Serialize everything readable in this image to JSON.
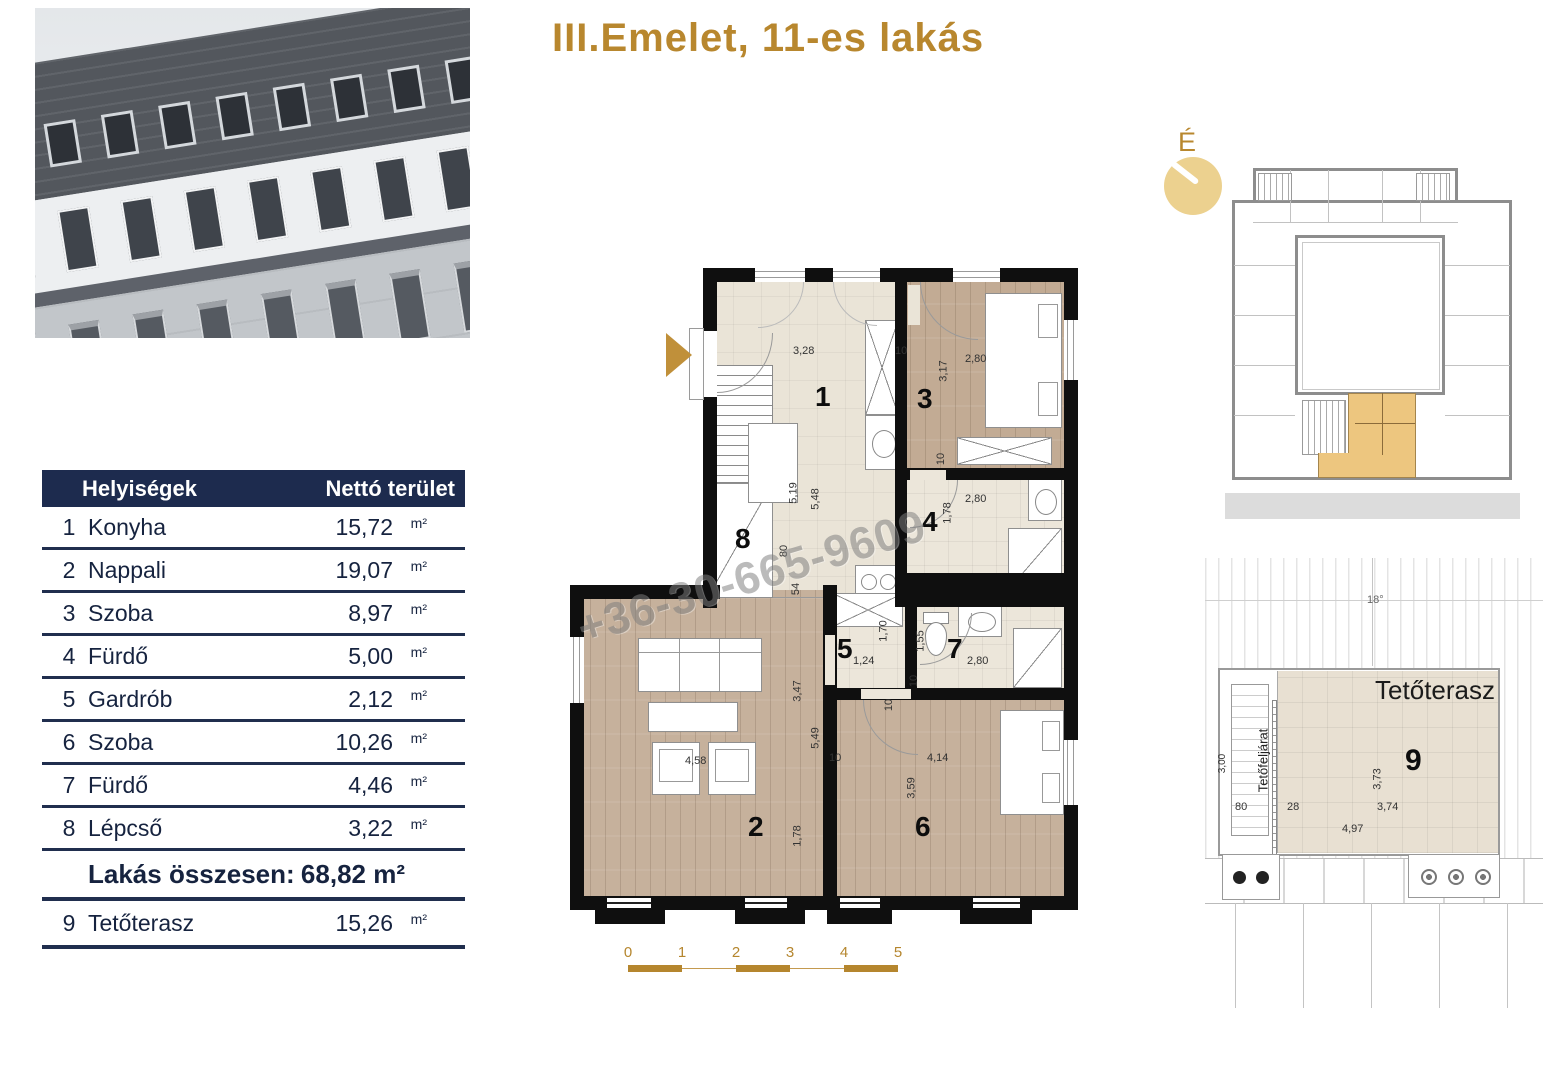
{
  "title": "III.Emelet, 11-es lakás",
  "table": {
    "col_rooms": "Helyiségek",
    "col_area": "Nettó terület",
    "rows": [
      {
        "num": "1",
        "name": "Konyha",
        "value": "15,72",
        "unit": "m²"
      },
      {
        "num": "2",
        "name": "Nappali",
        "value": "19,07",
        "unit": "m²"
      },
      {
        "num": "3",
        "name": "Szoba",
        "value": "8,97",
        "unit": "m²"
      },
      {
        "num": "4",
        "name": "Fürdő",
        "value": "5,00",
        "unit": "m²"
      },
      {
        "num": "5",
        "name": "Gardrób",
        "value": "2,12",
        "unit": "m²"
      },
      {
        "num": "6",
        "name": "Szoba",
        "value": "10,26",
        "unit": "m²"
      },
      {
        "num": "7",
        "name": "Fürdő",
        "value": "4,46",
        "unit": "m²"
      },
      {
        "num": "8",
        "name": "Lépcső",
        "value": "3,22",
        "unit": "m²"
      }
    ],
    "total_label": "Lakás összesen:",
    "total_value": "68,82 m²",
    "terrace_row": {
      "num": "9",
      "name": "Tetőterasz",
      "value": "15,26",
      "unit": "m²"
    }
  },
  "plan": {
    "watermark": "+36-30-665-9609",
    "room1": {
      "num": "1",
      "d_328": "3,28",
      "d_10": "10",
      "d_519": "5,19",
      "d_548": "5,48"
    },
    "room2": {
      "num": "2",
      "d_458": "4,58",
      "d_347": "3,47",
      "d_549": "5,49",
      "d_178": "1,78"
    },
    "room3": {
      "num": "3",
      "d_280": "2,80",
      "d_317": "3,17",
      "d_10": "10"
    },
    "room4": {
      "num": "4",
      "d_280": "2,80",
      "d_178": "1,78"
    },
    "room5": {
      "num": "5",
      "d_124": "1,24",
      "d_170": "1,70"
    },
    "room6": {
      "num": "6",
      "d_414": "4,14",
      "d_359": "3,59",
      "d_10a": "10",
      "d_10b": "10"
    },
    "room7": {
      "num": "7",
      "d_280": "2,80",
      "d_155": "1,55",
      "d_10": "10",
      "washer": "M"
    },
    "room8": {
      "num": "8",
      "d_80": "80",
      "d_54": "54"
    }
  },
  "scalebar": {
    "ticks": [
      "0",
      "1",
      "2",
      "3",
      "4",
      "5"
    ]
  },
  "siteplan": {
    "compass": "É"
  },
  "terrace": {
    "title": "Tetőterasz",
    "num": "9",
    "angle": "18°",
    "stair_label": "Tetőfeljárat",
    "d_300": "3,00",
    "d_80": "80",
    "d_28": "28",
    "d_373": "3,73",
    "d_374": "3,74",
    "d_497": "4,97"
  },
  "colors": {
    "gold": "#b8872e",
    "navy": "#1d2b4e",
    "highlight": "#edc67f"
  }
}
